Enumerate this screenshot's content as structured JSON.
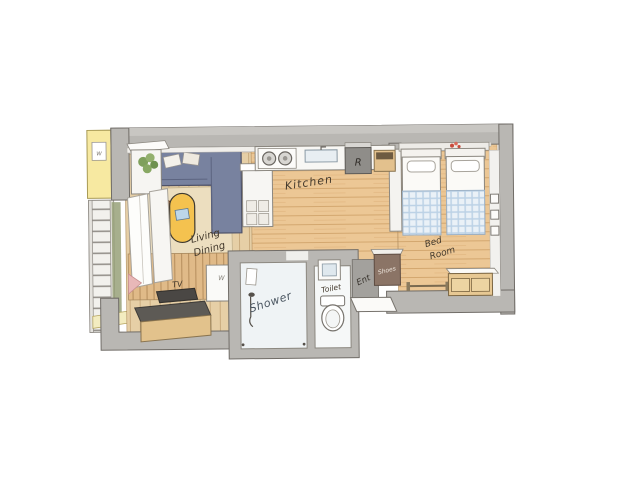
{
  "scene": {
    "description": "Hand-drawn axonometric floor plan of a studio apartment",
    "background": "#ffffff"
  },
  "rooms": {
    "kitchen": {
      "label": "Kitchen"
    },
    "living_dining": {
      "line1": "Living",
      "line2": "Dining"
    },
    "bedroom": {
      "line1": "Bed",
      "line2": "Room",
      "bed_count": 2
    },
    "shower": {
      "label": "Shower"
    },
    "toilet": {
      "label": "Toilet"
    },
    "entrance": {
      "label": "Ent"
    }
  },
  "items": {
    "shoe_cabinet": "Shoes",
    "tv": "TV",
    "appliance_r": "R",
    "washing_machine": "W",
    "wall_frame": "w"
  },
  "colors": {
    "wall": "#b9b7b3",
    "wood_floor": "#ecc795",
    "living_floor": "#e6cfa6",
    "rug": "#ecdebf",
    "sofa": "#78829f",
    "table": "#f4c24f",
    "chair_orange": "#e9632c",
    "chair_brown": "#aa7045",
    "bed_blanket_check": "#bcd2e6",
    "balcony_wall": "#f7e9a1",
    "shoe_cabinet": "#8b7466",
    "shower_floor": "#eff3f5",
    "entrance_floor": "#a3a19d",
    "tv_screen": "#4a4744"
  }
}
